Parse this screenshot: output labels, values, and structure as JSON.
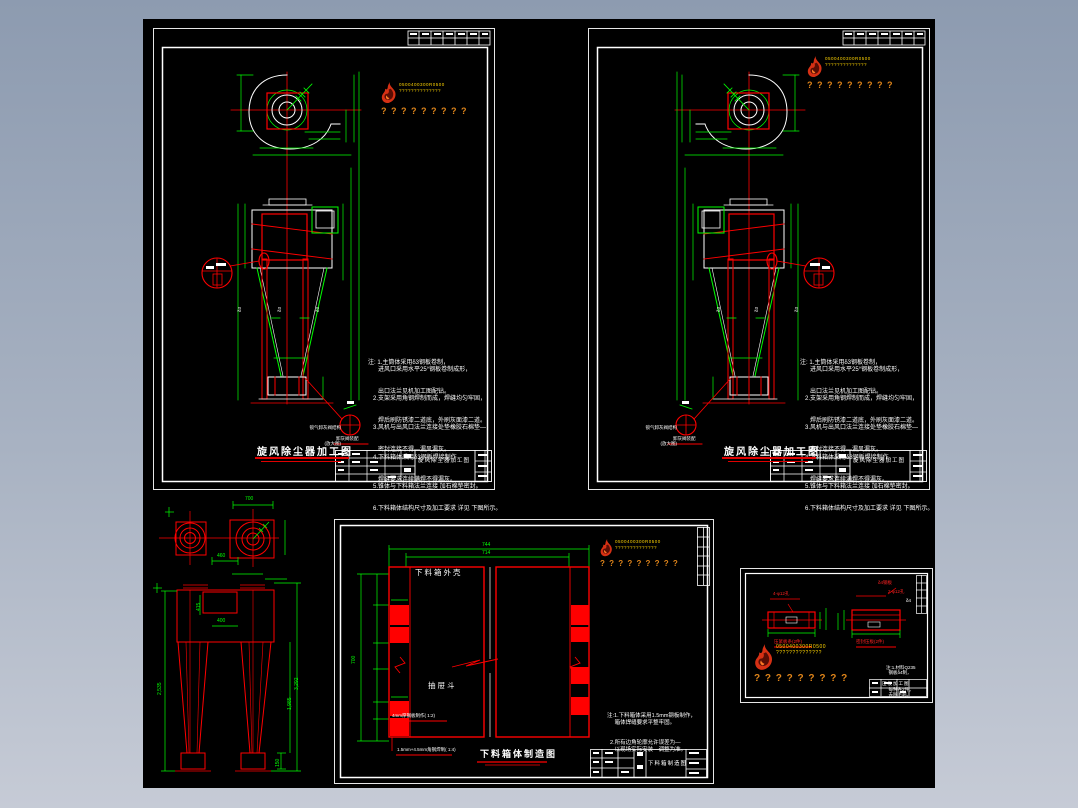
{
  "page": {
    "bg_top": "#8d9bb0",
    "bg_bottom": "#c6cbd6",
    "canvas_color": "#000000"
  },
  "colors": {
    "line_red": "#ff0000",
    "dim_green": "#00ff00",
    "line_white": "#ffffff",
    "wm_yellow": "#ffd400",
    "wm_orange": "#e0851a"
  },
  "watermark": {
    "flame_icon": "flame-logo",
    "row1": "0500400300R0500",
    "row2": "??????????????",
    "row3": "? ? ? ? ? ? ? ? ?"
  },
  "cyclone": {
    "title": "旋风除尘器加工图",
    "titleblock_name": "旋风除尘器加工图",
    "delta": "δ3",
    "detail_label_line1": "锁气卸灰阀结构",
    "detail_label_line2": "(放大图)",
    "detail_caption": "卸灰阀装配",
    "notes": [
      "注: 1.主筒体采用δ3钢板卷制，",
      "      进风口采用水平25°钢板卷制成形，",
      "      出口法兰见机加工图配钻。",
      "   2.支架采用角钢焊制而成，焊缝均匀牢固，",
      "      焊后刷防锈漆二道底，外刷灰面漆二道。",
      "   3.风机与出风口法兰连接处垫橡胶石棉垫—",
      "      密封连接不得—漏风漏灰。",
      "   4.下料箱体采用δ3钢板焊接制作，",
      "      焊缝要求连续满焊不得漏灰。",
      "   5.锥体与下料箱法兰连接 加石棉垫密封。",
      "   6.下料箱体结构尺寸及加工要求 详见 下图所示。"
    ]
  },
  "twin": {
    "dim_top": "700",
    "dim_gap": "460",
    "dim_mid": "400",
    "dim_neck": "415",
    "dim_height_left": "2,535",
    "dim_height_right": "3,292",
    "dim_cone": "1,985",
    "dim_base": "150"
  },
  "hopper": {
    "title": "下料箱体制造图",
    "titleblock_name": "下料箱制造图",
    "label_shell": "下料箱外壳",
    "label_drawer": "抽屉斗",
    "small_note_top": "4mm厚钢板制作( 1:2)",
    "small_note_bottom": "1.5mm+4.5mm角钢焊制( 1:4)",
    "dim_outer": "744",
    "dim_inner": "714",
    "dim_left": "700",
    "notes": [
      "注:1.下料箱体采用1.5mm钢板制作，",
      "     箱体焊缝要求平整牢固。",
      "  2.所有边角轮廓允许误差为—",
      "     以现场实际安装—调整为准。"
    ]
  },
  "parts": {
    "titleblock_name": "压板加工图",
    "label_left": "压紧板条(2件)",
    "label_right": "密封压板(2件)",
    "leader_left": "4-φ12孔",
    "leader_right1": "δ4钢板",
    "leader_right2": "2-φ12孔",
    "white_note": "δ4",
    "notes": [
      "注:1.材料Q235",
      "  钢板δ4制，",
      "  每种各2件，",
      "  去除毛刺。"
    ]
  }
}
